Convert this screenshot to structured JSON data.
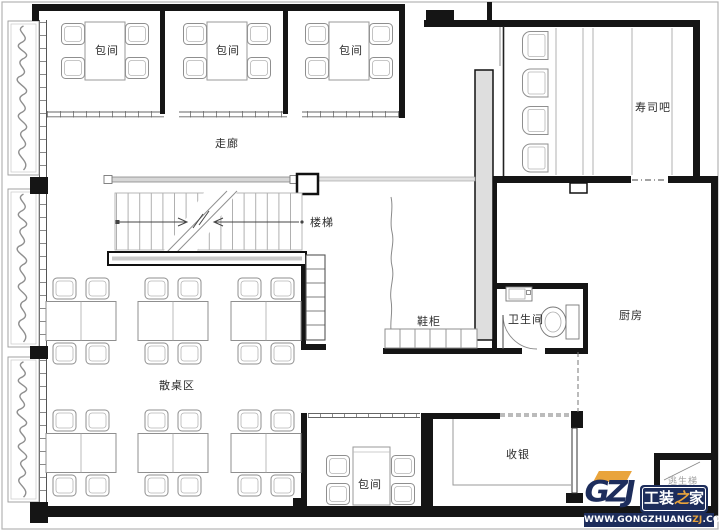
{
  "labels": {
    "private_rooms": [
      "包间",
      "包间",
      "包间",
      "包间"
    ],
    "corridor": "走廊",
    "stairs": "楼梯",
    "sushi_bar": "寿司吧",
    "open_dining_area": "散桌区",
    "shoe_cabinet": "鞋柜",
    "restroom": "卫生间",
    "kitchen": "厨房",
    "cashier": "收银",
    "escape_stair": "逃生梯"
  },
  "watermark": {
    "logo_abbr": "GZJ",
    "brand_pre": "工装",
    "brand_accent": "之",
    "brand_post": "家",
    "url_pre": "WWW.GONGZHUANG",
    "url_accent": "ZJ",
    "url_post": ".COM",
    "navy": "#1d2d5c",
    "orange": "#e9a43c"
  },
  "colors": {
    "wall": "#151515",
    "furniture_line": "#8f8f8f",
    "label_text": "#2b2b2b",
    "background": "#ffffff"
  }
}
